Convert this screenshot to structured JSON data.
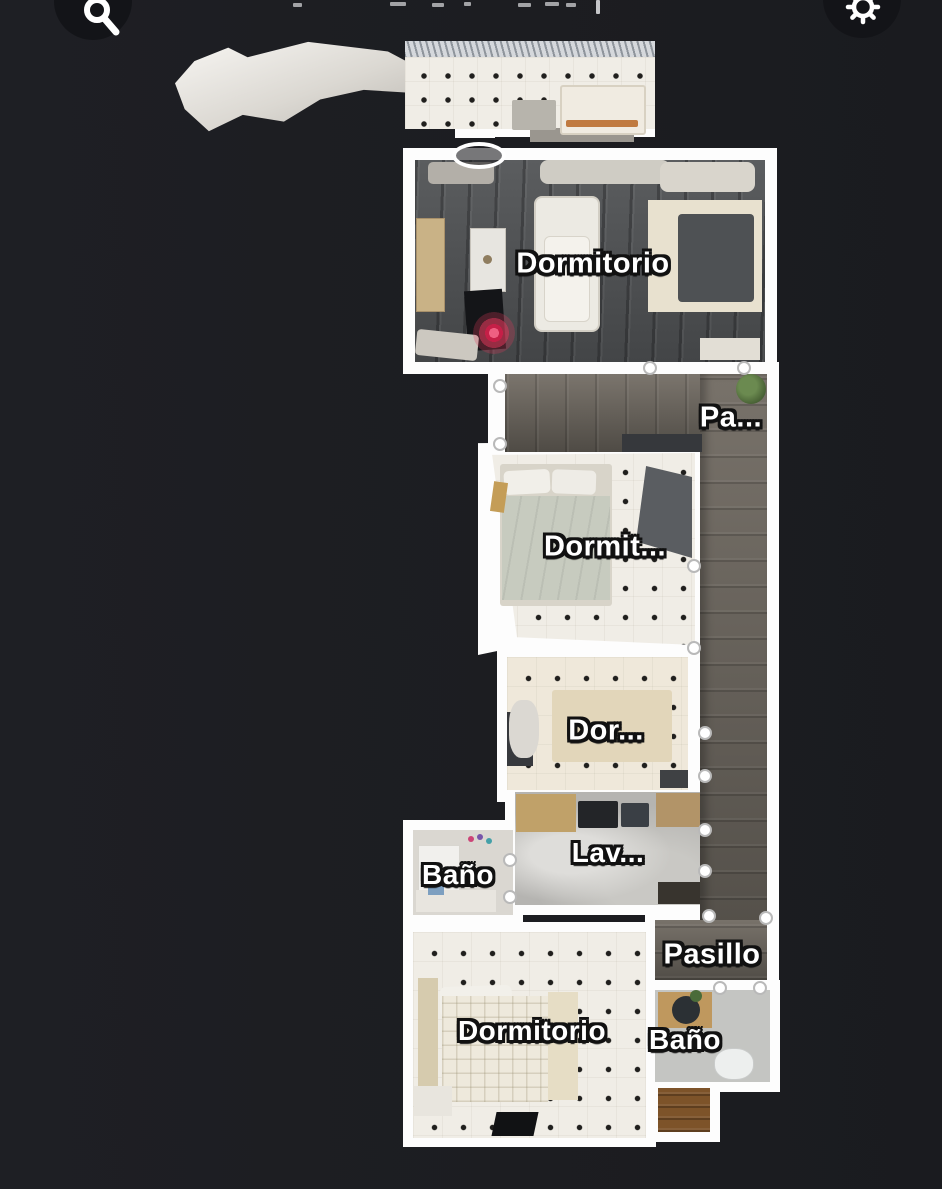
{
  "toolbar": {
    "search_button": {
      "icon": "search-icon"
    },
    "settings_button": {
      "icon": "gear-icon"
    }
  },
  "floorplan": {
    "wall_color": "#fdfdfd",
    "background_color": "#1d1e22",
    "camera_marker_color": "#de385a",
    "rooms": [
      {
        "label": "Dormitorio"
      },
      {
        "label": "Pa..."
      },
      {
        "label": "Dormit..."
      },
      {
        "label": "Dor..."
      },
      {
        "label": "Lav..."
      },
      {
        "label": "Baño"
      },
      {
        "label": "Pasillo"
      },
      {
        "label": "Dormitorio"
      },
      {
        "label": "Baño"
      }
    ]
  }
}
